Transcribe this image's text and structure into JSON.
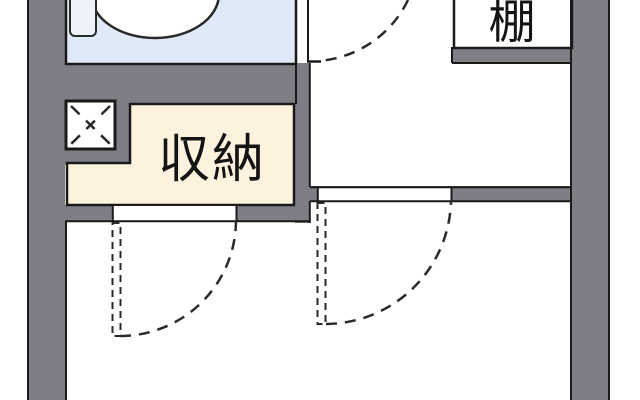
{
  "floorplan": {
    "type": "apartment-floor-plan",
    "labels": {
      "shelf": "棚",
      "storage": "収納"
    },
    "colors": {
      "wall_gray": "#7E7E86",
      "outline": "#1A1A1A",
      "door_dash": "#2A2A2A",
      "toilet_room_fill": "#DFE9F7",
      "toilet_fixture_fill": "#FFFFFF",
      "toilet_tank_fill": "#EEF3FB",
      "storage_fill": "#FCF2DD",
      "room_fill": "#FFFFFF"
    },
    "features": {
      "toilet": "toilet-fixture",
      "pipe_shaft": "x-crossed-box",
      "door_swing_count": 3
    }
  }
}
